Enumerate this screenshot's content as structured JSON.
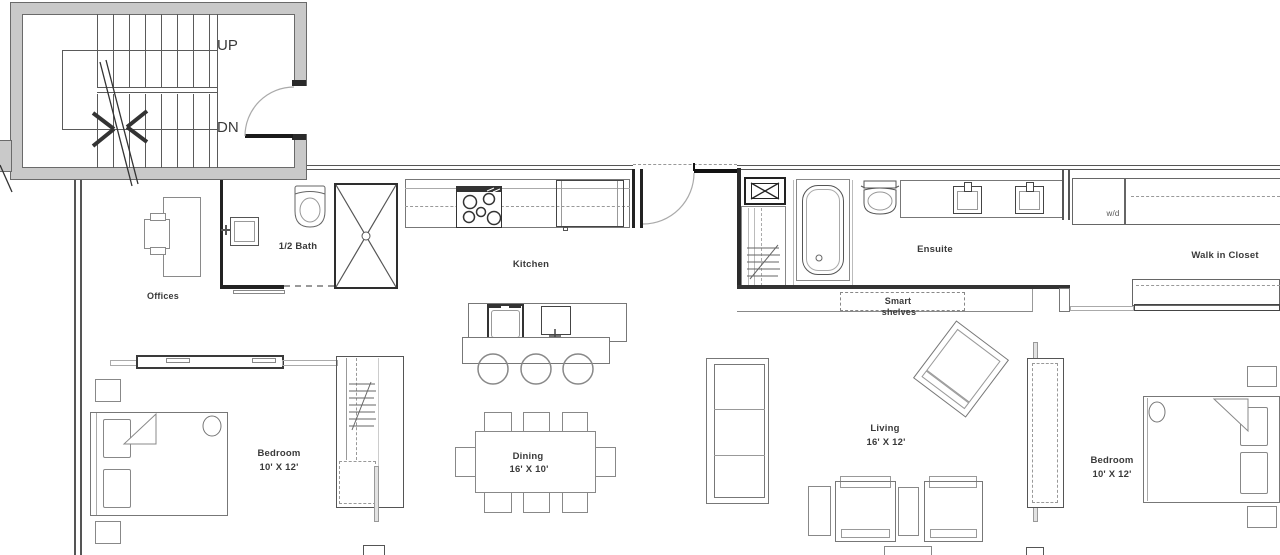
{
  "stairwell": {
    "up": "UP",
    "dn": "DN"
  },
  "rooms": {
    "offices": {
      "label": "Offices"
    },
    "half_bath": {
      "label": "1/2 Bath"
    },
    "kitchen": {
      "label": "Kitchen"
    },
    "ensuite": {
      "label": "Ensuite"
    },
    "walk_in_closet": {
      "label": "Walk in Closet"
    },
    "bedroom_left": {
      "label": "Bedroom",
      "dims": "10' X 12'"
    },
    "dining": {
      "label": "Dining",
      "dims": "16' X 10'"
    },
    "living": {
      "label": "Living",
      "dims": "16' X 12'"
    },
    "bedroom_right": {
      "label": "Bedroom",
      "dims": "10' X 12'"
    }
  },
  "fixtures": {
    "smart_shelves_line1": "Smart",
    "smart_shelves_line2": "shelves",
    "washer_dryer": "w/d"
  },
  "colors": {
    "background": "#ffffff",
    "wall_fill": "#c9c9c9",
    "wall_line": "#555555",
    "line_dark": "#222222",
    "line_mid": "#777777",
    "line_light": "#aaaaaa",
    "text": "#3a3a3a"
  }
}
